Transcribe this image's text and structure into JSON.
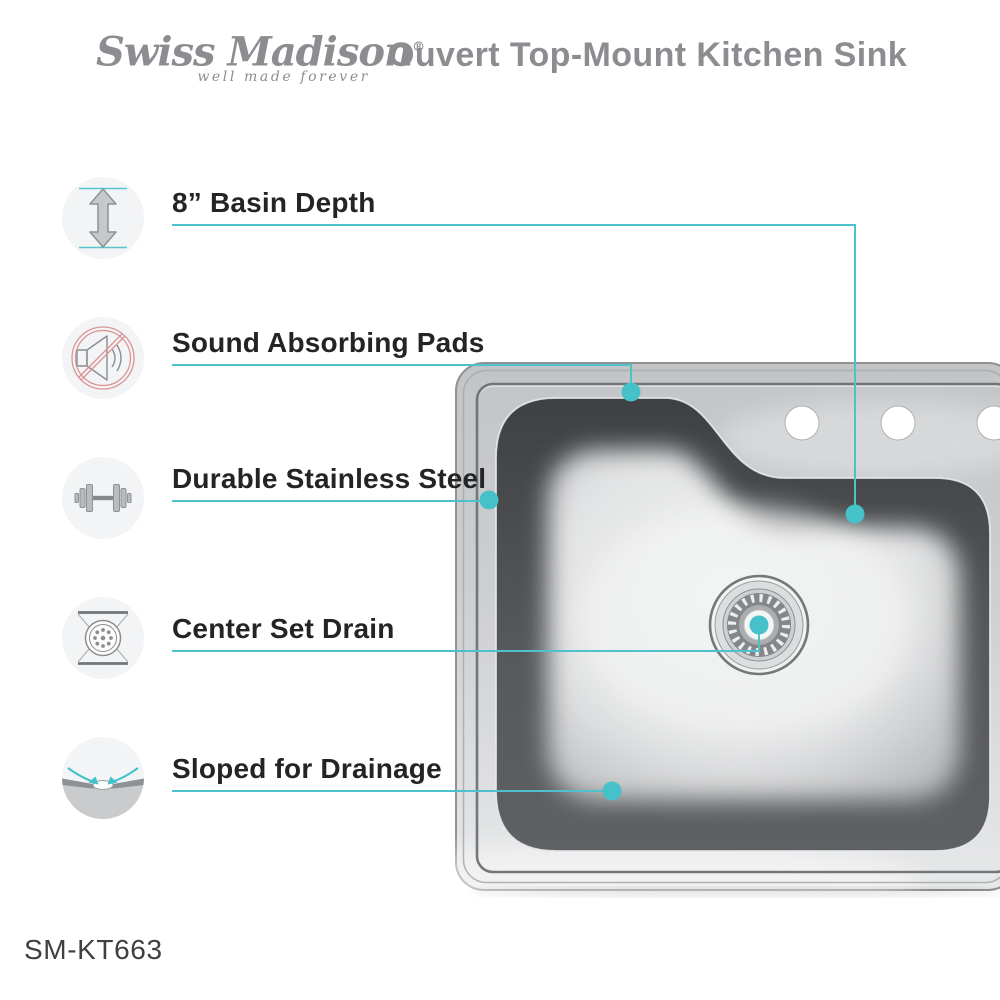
{
  "header": {
    "brand": "Swiss Madison",
    "registered_mark": "®",
    "tagline": "well made forever",
    "title": "Ouvert Top-Mount Kitchen Sink"
  },
  "features": [
    {
      "label": "8” Basin Depth",
      "icon": "basin-depth-arrow-icon"
    },
    {
      "label": "Sound Absorbing Pads",
      "icon": "muted-speaker-icon"
    },
    {
      "label": "Durable Stainless Steel",
      "icon": "dumbbell-icon"
    },
    {
      "label": "Center Set Drain",
      "icon": "drain-strainer-icon"
    },
    {
      "label": "Sloped for Drainage",
      "icon": "sloped-basin-icon"
    }
  ],
  "model_number": "SM-KT663",
  "colors": {
    "accent_teal": "#4CC3CC",
    "label_text": "#232426",
    "brand_gray": "#8B8D90",
    "no_symbol_red": "#DB9496",
    "steel_light": "#E8E9EA",
    "steel_dark": "#3E4042"
  }
}
